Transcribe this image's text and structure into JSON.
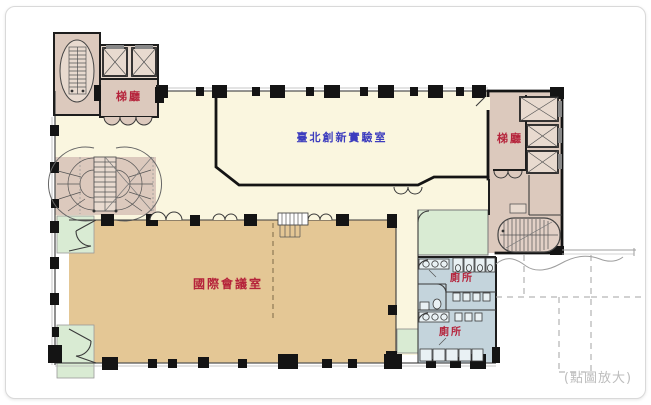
{
  "figure": {
    "title": "floor-plan",
    "enlarge_hint": "(點圖放大)"
  },
  "rooms": {
    "stair_hall_left": {
      "label": "梯廳"
    },
    "stair_hall_right": {
      "label": "梯廳"
    },
    "innovation_lab": {
      "label": "臺北創新實驗室"
    },
    "conference_room": {
      "label": "國際會議室"
    },
    "toilet_upper": {
      "label": "廁所"
    },
    "toilet_lower": {
      "label": "廁所"
    }
  },
  "colors": {
    "lab_floor": "#faf6df",
    "conference_floor": "#e4c795",
    "stair_hall_floor": "#dcc9bd",
    "stair_core_floor": "#e8dacf",
    "toilet_floor": "#c4d4dc",
    "balcony_floor": "#d9ebd3",
    "wall": "#141414",
    "label_red": "#b5223a",
    "label_blue": "#3c3cbe",
    "hint_gray": "#bdbdbd"
  }
}
